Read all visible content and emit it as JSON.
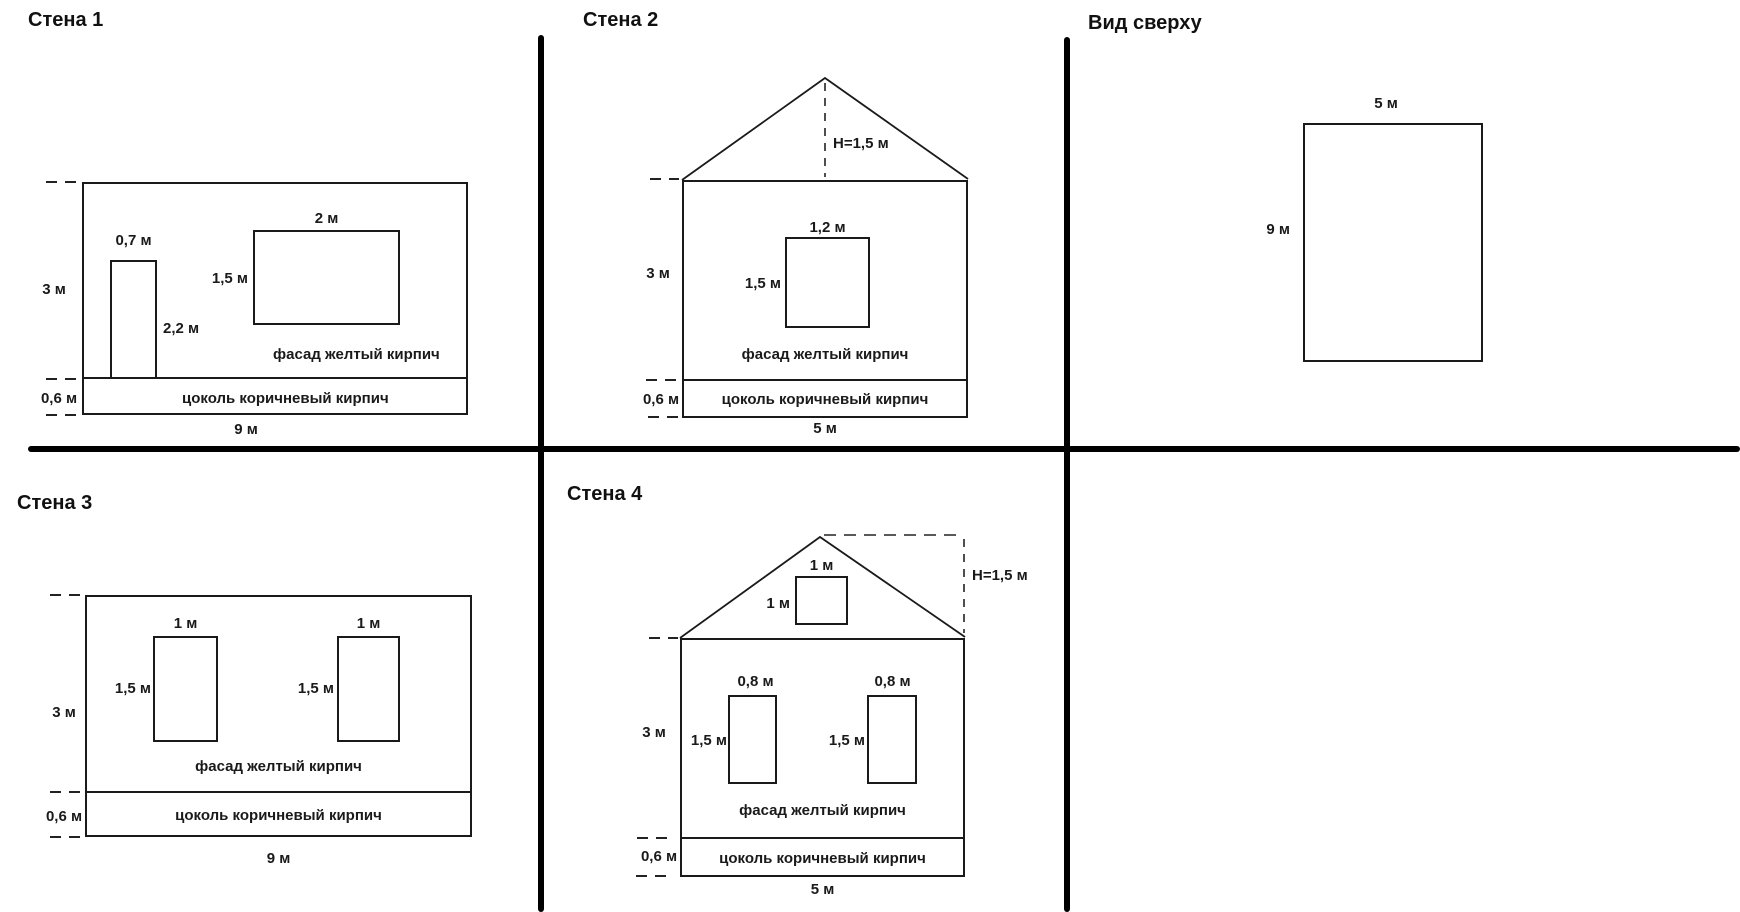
{
  "colors": {
    "line": "#1a1a1a",
    "divider": "#000000",
    "background": "#ffffff"
  },
  "wall1": {
    "title": "Стена 1",
    "height": "3 м",
    "width": "9 м",
    "plinth_height": "0,6 м",
    "door": {
      "width": "0,7 м",
      "height": "2,2 м"
    },
    "window": {
      "width": "2 м",
      "height": "1,5 м"
    },
    "facade_label": "фасад желтый кирпич",
    "plinth_label": "цоколь коричневый кирпич"
  },
  "wall2": {
    "title": "Стена 2",
    "roof_height": "Н=1,5 м",
    "height": "3 м",
    "width": "5 м",
    "plinth_height": "0,6 м",
    "window": {
      "width": "1,2 м",
      "height": "1,5 м"
    },
    "facade_label": "фасад желтый кирпич",
    "plinth_label": "цоколь коричневый кирпич"
  },
  "top_view": {
    "title": "Вид сверху",
    "width": "5 м",
    "depth": "9 м"
  },
  "wall3": {
    "title": "Стена 3",
    "height": "3 м",
    "width": "9 м",
    "plinth_height": "0,6 м",
    "window1": {
      "width": "1 м",
      "height": "1,5 м"
    },
    "window2": {
      "width": "1 м",
      "height": "1,5 м"
    },
    "facade_label": "фасад желтый кирпич",
    "plinth_label": "цоколь коричневый кирпич"
  },
  "wall4": {
    "title": "Стена 4",
    "roof_height": "Н=1,5 м",
    "gable_window": {
      "width": "1 м",
      "height": "1 м"
    },
    "height": "3 м",
    "width": "5 м",
    "plinth_height": "0,6 м",
    "window1": {
      "width": "0,8 м",
      "height": "1,5 м"
    },
    "window2": {
      "width": "0,8 м",
      "height": "1,5 м"
    },
    "facade_label": "фасад желтый кирпич",
    "plinth_label": "цоколь коричневый кирпич"
  }
}
